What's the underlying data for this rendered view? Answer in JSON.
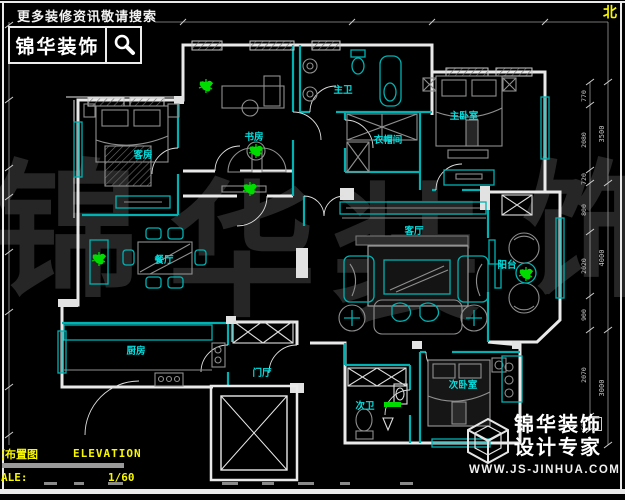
{
  "header": {
    "tagline": "更多装修资讯敬请搜索",
    "brand": "锦华装饰"
  },
  "compass": {
    "north": "北"
  },
  "watermark": {
    "c1": "锦",
    "c2": "华",
    "c3": "装",
    "c4": "饰"
  },
  "rooms": {
    "guest_room": "客房",
    "study": "书房",
    "master_bath": "主卫",
    "closet": "衣帽间",
    "master_bedroom": "主卧室",
    "dining": "餐厅",
    "living": "客厅",
    "balcony": "阳台",
    "kitchen": "厨房",
    "foyer": "门厅",
    "second_bath": "次卫",
    "second_bedroom": "次卧室"
  },
  "dimensions": {
    "right_inner": [
      "770",
      "2080",
      "720",
      "800",
      "2020",
      "900",
      "2070",
      "600"
    ],
    "right_outer": [
      "3500",
      "4000",
      "3000"
    ]
  },
  "title_block": {
    "title_cn": "面布置图",
    "title_en": "ELEVATION",
    "scale_label": "ALE:",
    "scale_value": "1/60"
  },
  "brand_footer": {
    "name": "锦华装饰",
    "tagline": "设计专家",
    "website": "WWW.JS-JINHUA.COM"
  },
  "colors": {
    "wall_cyan": "#00b2b2",
    "label_cyan": "#00e0e0",
    "accent_yellow": "#f8f800",
    "plant_green": "#00dc00"
  }
}
